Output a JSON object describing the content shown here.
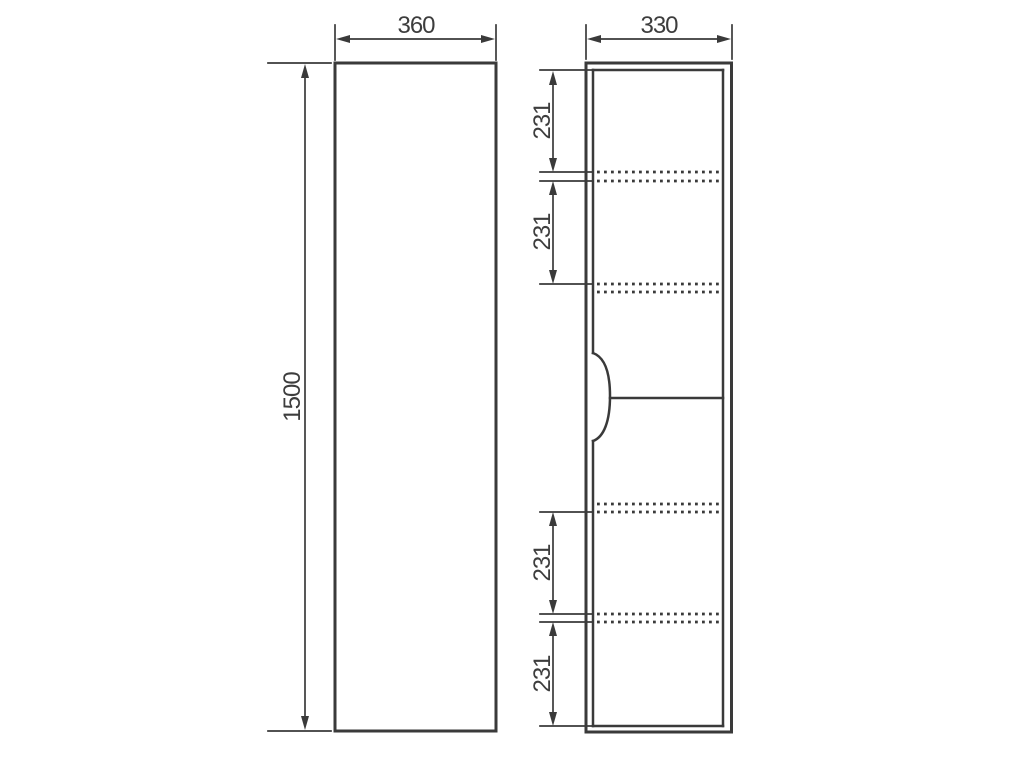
{
  "drawing": {
    "front_view": {
      "width_label": "360",
      "height_label": "1500"
    },
    "side_view": {
      "depth_label": "330",
      "compartment_labels": [
        "231",
        "231",
        "231",
        "231"
      ]
    },
    "colors": {
      "line": "#3a3a3a",
      "background": "#ffffff"
    }
  }
}
